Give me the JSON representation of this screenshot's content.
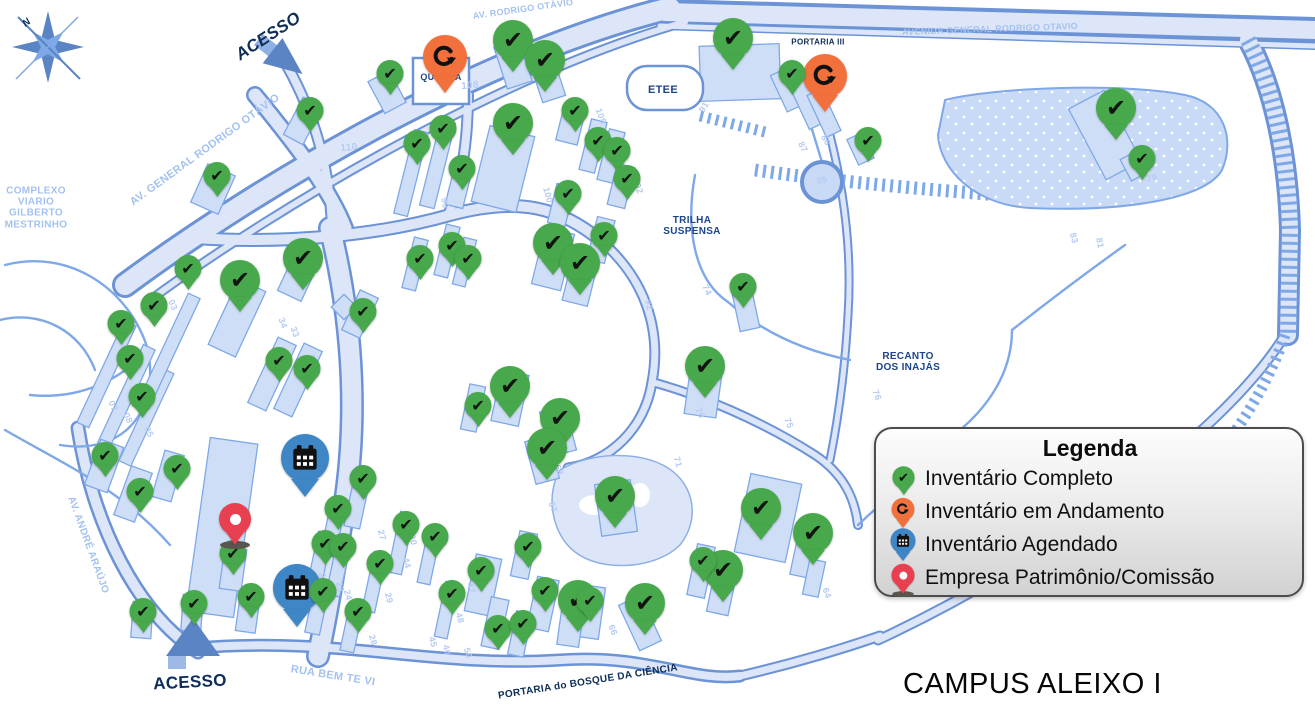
{
  "title": "CAMPUS ALEIXO I",
  "legend": {
    "title": "Legenda",
    "items": [
      {
        "type": "complete",
        "label": "Inventário Completo",
        "color": "#47a84c"
      },
      {
        "type": "in_progress",
        "label": "Inventário em Andamento",
        "color": "#f2703c"
      },
      {
        "type": "scheduled",
        "label": "Inventário Agendado",
        "color": "#3e86c6"
      },
      {
        "type": "company",
        "label": "Empresa Patrimônio/Comissão",
        "color": "#e84050"
      }
    ]
  },
  "map_labels": [
    {
      "text": "N",
      "x": 27,
      "y": 23,
      "rot": -40,
      "cls": "navy b i",
      "size": 10
    },
    {
      "text": "ACESSO",
      "x": 268,
      "y": 36,
      "rot": -33,
      "cls": "navy b i",
      "size": 17
    },
    {
      "text": "AV. GENERAL RODRIGO OTÁVIO",
      "x": 205,
      "y": 150,
      "rot": -36,
      "cls": "light b",
      "size": 11
    },
    {
      "text": "AV. RODRIGO OTÁVIO",
      "x": 523,
      "y": 9,
      "rot": -8,
      "cls": "light b",
      "size": 9
    },
    {
      "text": "AVENIDA GENERAL RODRIGO OTAVIO",
      "x": 990,
      "y": 29,
      "rot": -2,
      "cls": "light b",
      "size": 9
    },
    {
      "text": "COMPLEXO\nVIARIO\nGILBERTO\nMESTRINHO",
      "x": 36,
      "y": 208,
      "rot": 0,
      "cls": "light b",
      "size": 10
    },
    {
      "text": "PORTARIA III",
      "x": 818,
      "y": 43,
      "rot": 0,
      "cls": "navy b",
      "size": 8
    },
    {
      "text": "ETEE",
      "x": 663,
      "y": 90,
      "rot": 0,
      "cls": "blue b",
      "size": 11
    },
    {
      "text": "TRILHA\nSUSPENSA",
      "x": 692,
      "y": 226,
      "rot": 0,
      "cls": "blue b",
      "size": 10
    },
    {
      "text": "RECANTO\nDOS INAJÁS",
      "x": 908,
      "y": 362,
      "rot": 0,
      "cls": "blue b",
      "size": 10
    },
    {
      "text": "QUADRA",
      "x": 441,
      "y": 77,
      "rot": 0,
      "cls": "blue b",
      "size": 9
    },
    {
      "text": "AV. ANDRÉ ARAÚJO",
      "x": 88,
      "y": 545,
      "rot": 70,
      "cls": "light b",
      "size": 10
    },
    {
      "text": "RUA BEM TE VI",
      "x": 333,
      "y": 676,
      "rot": 9,
      "cls": "light b",
      "size": 11
    },
    {
      "text": "PORTARIA do BOSQUE DA CIÊNCIA",
      "x": 588,
      "y": 682,
      "rot": -9,
      "cls": "navy b",
      "size": 10
    },
    {
      "text": "ACESSO",
      "x": 190,
      "y": 682,
      "rot": -3,
      "cls": "navy b",
      "size": 17
    },
    {
      "text": "108",
      "x": 470,
      "y": 86,
      "rot": -5,
      "cls": "num b",
      "size": 10
    },
    {
      "text": "110",
      "x": 349,
      "y": 148,
      "rot": -5,
      "cls": "num b",
      "size": 10
    },
    {
      "text": "100",
      "x": 548,
      "y": 195,
      "rot": 75,
      "cls": "num b",
      "size": 9
    },
    {
      "text": "105",
      "x": 601,
      "y": 116,
      "rot": 70,
      "cls": "num b",
      "size": 9
    },
    {
      "text": "104",
      "x": 609,
      "y": 140,
      "rot": 70,
      "cls": "num b",
      "size": 9
    },
    {
      "text": "102",
      "x": 638,
      "y": 186,
      "rot": 70,
      "cls": "num b",
      "size": 9
    },
    {
      "text": "99",
      "x": 445,
      "y": 203,
      "rot": 80,
      "cls": "num b",
      "size": 9
    },
    {
      "text": "91",
      "x": 704,
      "y": 107,
      "rot": -60,
      "cls": "num b",
      "size": 9
    },
    {
      "text": "87",
      "x": 803,
      "y": 147,
      "rot": 60,
      "cls": "num b",
      "size": 9
    },
    {
      "text": "86",
      "x": 826,
      "y": 140,
      "rot": 60,
      "cls": "num b",
      "size": 9
    },
    {
      "text": "85",
      "x": 822,
      "y": 180,
      "rot": -15,
      "cls": "num b",
      "size": 9
    },
    {
      "text": "79",
      "x": 1152,
      "y": 178,
      "rot": -10,
      "cls": "num b",
      "size": 9
    },
    {
      "text": "83",
      "x": 1074,
      "y": 238,
      "rot": 75,
      "cls": "num b",
      "size": 9
    },
    {
      "text": "81",
      "x": 1100,
      "y": 243,
      "rot": 80,
      "cls": "num b",
      "size": 9
    },
    {
      "text": "92",
      "x": 649,
      "y": 305,
      "rot": 75,
      "cls": "num b",
      "size": 9
    },
    {
      "text": "74",
      "x": 707,
      "y": 290,
      "rot": 65,
      "cls": "num b",
      "size": 9
    },
    {
      "text": "76",
      "x": 877,
      "y": 395,
      "rot": 70,
      "cls": "num b",
      "size": 9
    },
    {
      "text": "75",
      "x": 789,
      "y": 423,
      "rot": 70,
      "cls": "num b",
      "size": 9
    },
    {
      "text": "70",
      "x": 700,
      "y": 413,
      "rot": 65,
      "cls": "num b",
      "size": 9
    },
    {
      "text": "71",
      "x": 678,
      "y": 462,
      "rot": 75,
      "cls": "num b",
      "size": 9
    },
    {
      "text": "64",
      "x": 827,
      "y": 593,
      "rot": 70,
      "cls": "num b",
      "size": 9
    },
    {
      "text": "68",
      "x": 559,
      "y": 470,
      "rot": 70,
      "cls": "num b",
      "size": 9
    },
    {
      "text": "67",
      "x": 553,
      "y": 507,
      "rot": 70,
      "cls": "num b",
      "size": 9
    },
    {
      "text": "66",
      "x": 613,
      "y": 630,
      "rot": 70,
      "cls": "num b",
      "size": 9
    },
    {
      "text": "44",
      "x": 407,
      "y": 563,
      "rot": 75,
      "cls": "num b",
      "size": 9
    },
    {
      "text": "45",
      "x": 433,
      "y": 642,
      "rot": 75,
      "cls": "num b",
      "size": 9
    },
    {
      "text": "46",
      "x": 447,
      "y": 650,
      "rot": 75,
      "cls": "num b",
      "size": 9
    },
    {
      "text": "47",
      "x": 471,
      "y": 588,
      "rot": 75,
      "cls": "num b",
      "size": 9
    },
    {
      "text": "48",
      "x": 460,
      "y": 618,
      "rot": 75,
      "cls": "num b",
      "size": 9
    },
    {
      "text": "50",
      "x": 468,
      "y": 653,
      "rot": 75,
      "cls": "num b",
      "size": 9
    },
    {
      "text": "21",
      "x": 323,
      "y": 578,
      "rot": 75,
      "cls": "num b",
      "size": 9
    },
    {
      "text": "23",
      "x": 340,
      "y": 587,
      "rot": 75,
      "cls": "num b",
      "size": 9
    },
    {
      "text": "24",
      "x": 348,
      "y": 595,
      "rot": 75,
      "cls": "num b",
      "size": 9
    },
    {
      "text": "27",
      "x": 382,
      "y": 535,
      "rot": 75,
      "cls": "num b",
      "size": 9
    },
    {
      "text": "28",
      "x": 373,
      "y": 640,
      "rot": 75,
      "cls": "num b",
      "size": 9
    },
    {
      "text": "29",
      "x": 389,
      "y": 598,
      "rot": 75,
      "cls": "num b",
      "size": 9
    },
    {
      "text": "30",
      "x": 413,
      "y": 540,
      "rot": 75,
      "cls": "num b",
      "size": 9
    },
    {
      "text": "05",
      "x": 149,
      "y": 432,
      "rot": 65,
      "cls": "num b",
      "size": 9
    },
    {
      "text": "07",
      "x": 113,
      "y": 406,
      "rot": 65,
      "cls": "num b",
      "size": 9
    },
    {
      "text": "08",
      "x": 128,
      "y": 418,
      "rot": 65,
      "cls": "num b",
      "size": 9
    },
    {
      "text": "03",
      "x": 173,
      "y": 305,
      "rot": 65,
      "cls": "num b",
      "size": 9
    },
    {
      "text": "34",
      "x": 283,
      "y": 323,
      "rot": 70,
      "cls": "num b",
      "size": 9
    },
    {
      "text": "33",
      "x": 295,
      "y": 332,
      "rot": 70,
      "cls": "num b",
      "size": 9
    },
    {
      "text": "37",
      "x": 313,
      "y": 360,
      "rot": 70,
      "cls": "num b",
      "size": 9
    }
  ],
  "markers": [
    {
      "type": "in_progress",
      "x": 445,
      "y": 93
    },
    {
      "type": "in_progress",
      "x": 825,
      "y": 112
    },
    {
      "type": "scheduled",
      "x": 305,
      "y": 497
    },
    {
      "type": "scheduled",
      "x": 297,
      "y": 627
    },
    {
      "type": "company",
      "x": 235,
      "y": 545
    },
    {
      "type": "complete",
      "size": "lg",
      "x": 240,
      "y": 312
    },
    {
      "type": "complete",
      "size": "lg",
      "x": 303,
      "y": 290
    },
    {
      "type": "complete",
      "size": "lg",
      "x": 513,
      "y": 72
    },
    {
      "type": "complete",
      "size": "lg",
      "x": 545,
      "y": 92
    },
    {
      "type": "complete",
      "size": "lg",
      "x": 513,
      "y": 155
    },
    {
      "type": "complete",
      "size": "lg",
      "x": 733,
      "y": 70
    },
    {
      "type": "complete",
      "size": "lg",
      "x": 1116,
      "y": 140
    },
    {
      "type": "complete",
      "size": "lg",
      "x": 553,
      "y": 275
    },
    {
      "type": "complete",
      "size": "lg",
      "x": 580,
      "y": 295
    },
    {
      "type": "complete",
      "size": "lg",
      "x": 705,
      "y": 398
    },
    {
      "type": "complete",
      "size": "lg",
      "x": 510,
      "y": 418
    },
    {
      "type": "complete",
      "size": "lg",
      "x": 560,
      "y": 450
    },
    {
      "type": "complete",
      "size": "lg",
      "x": 547,
      "y": 480
    },
    {
      "type": "complete",
      "size": "lg",
      "x": 615,
      "y": 528
    },
    {
      "type": "complete",
      "size": "lg",
      "x": 645,
      "y": 635
    },
    {
      "type": "complete",
      "size": "lg",
      "x": 578,
      "y": 632
    },
    {
      "type": "complete",
      "size": "lg",
      "x": 723,
      "y": 602
    },
    {
      "type": "complete",
      "size": "lg",
      "x": 761,
      "y": 540
    },
    {
      "type": "complete",
      "size": "lg",
      "x": 813,
      "y": 565
    },
    {
      "type": "complete",
      "size": "sm",
      "x": 310,
      "y": 132
    },
    {
      "type": "complete",
      "size": "sm",
      "x": 217,
      "y": 197
    },
    {
      "type": "complete",
      "size": "sm",
      "x": 390,
      "y": 95
    },
    {
      "type": "complete",
      "size": "sm",
      "x": 188,
      "y": 290
    },
    {
      "type": "complete",
      "size": "sm",
      "x": 154,
      "y": 327
    },
    {
      "type": "complete",
      "size": "sm",
      "x": 121,
      "y": 345
    },
    {
      "type": "complete",
      "size": "sm",
      "x": 130,
      "y": 380
    },
    {
      "type": "complete",
      "size": "sm",
      "x": 142,
      "y": 418
    },
    {
      "type": "complete",
      "size": "sm",
      "x": 363,
      "y": 333
    },
    {
      "type": "complete",
      "size": "sm",
      "x": 279,
      "y": 382
    },
    {
      "type": "complete",
      "size": "sm",
      "x": 307,
      "y": 390
    },
    {
      "type": "complete",
      "size": "sm",
      "x": 575,
      "y": 132
    },
    {
      "type": "complete",
      "size": "sm",
      "x": 443,
      "y": 150
    },
    {
      "type": "complete",
      "size": "sm",
      "x": 417,
      "y": 165
    },
    {
      "type": "complete",
      "size": "sm",
      "x": 462,
      "y": 190
    },
    {
      "type": "complete",
      "size": "sm",
      "x": 598,
      "y": 162
    },
    {
      "type": "complete",
      "size": "sm",
      "x": 617,
      "y": 172
    },
    {
      "type": "complete",
      "size": "sm",
      "x": 627,
      "y": 200
    },
    {
      "type": "complete",
      "size": "sm",
      "x": 568,
      "y": 215
    },
    {
      "type": "complete",
      "size": "sm",
      "x": 792,
      "y": 95
    },
    {
      "type": "complete",
      "size": "sm",
      "x": 868,
      "y": 162
    },
    {
      "type": "complete",
      "size": "sm",
      "x": 1142,
      "y": 180
    },
    {
      "type": "complete",
      "size": "sm",
      "x": 420,
      "y": 280
    },
    {
      "type": "complete",
      "size": "sm",
      "x": 452,
      "y": 267
    },
    {
      "type": "complete",
      "size": "sm",
      "x": 468,
      "y": 280
    },
    {
      "type": "complete",
      "size": "sm",
      "x": 604,
      "y": 257
    },
    {
      "type": "complete",
      "size": "sm",
      "x": 743,
      "y": 308
    },
    {
      "type": "complete",
      "size": "sm",
      "x": 478,
      "y": 427
    },
    {
      "type": "complete",
      "size": "sm",
      "x": 528,
      "y": 568
    },
    {
      "type": "complete",
      "size": "sm",
      "x": 481,
      "y": 592
    },
    {
      "type": "complete",
      "size": "sm",
      "x": 498,
      "y": 650
    },
    {
      "type": "complete",
      "size": "sm",
      "x": 523,
      "y": 645
    },
    {
      "type": "complete",
      "size": "sm",
      "x": 545,
      "y": 612
    },
    {
      "type": "complete",
      "size": "sm",
      "x": 590,
      "y": 622
    },
    {
      "type": "complete",
      "size": "sm",
      "x": 703,
      "y": 582
    },
    {
      "type": "complete",
      "size": "sm",
      "x": 105,
      "y": 477
    },
    {
      "type": "complete",
      "size": "sm",
      "x": 140,
      "y": 513
    },
    {
      "type": "complete",
      "size": "sm",
      "x": 177,
      "y": 490
    },
    {
      "type": "complete",
      "size": "sm",
      "x": 233,
      "y": 575
    },
    {
      "type": "complete",
      "size": "sm",
      "x": 251,
      "y": 618
    },
    {
      "type": "complete",
      "size": "sm",
      "x": 143,
      "y": 633
    },
    {
      "type": "complete",
      "size": "sm",
      "x": 194,
      "y": 625
    },
    {
      "type": "complete",
      "size": "sm",
      "x": 363,
      "y": 500
    },
    {
      "type": "complete",
      "size": "sm",
      "x": 338,
      "y": 530
    },
    {
      "type": "complete",
      "size": "sm",
      "x": 325,
      "y": 565
    },
    {
      "type": "complete",
      "size": "sm",
      "x": 343,
      "y": 568
    },
    {
      "type": "complete",
      "size": "sm",
      "x": 406,
      "y": 546
    },
    {
      "type": "complete",
      "size": "sm",
      "x": 380,
      "y": 585
    },
    {
      "type": "complete",
      "size": "sm",
      "x": 435,
      "y": 558
    },
    {
      "type": "complete",
      "size": "sm",
      "x": 323,
      "y": 613
    },
    {
      "type": "complete",
      "size": "sm",
      "x": 358,
      "y": 633
    },
    {
      "type": "complete",
      "size": "sm",
      "x": 452,
      "y": 615
    }
  ]
}
